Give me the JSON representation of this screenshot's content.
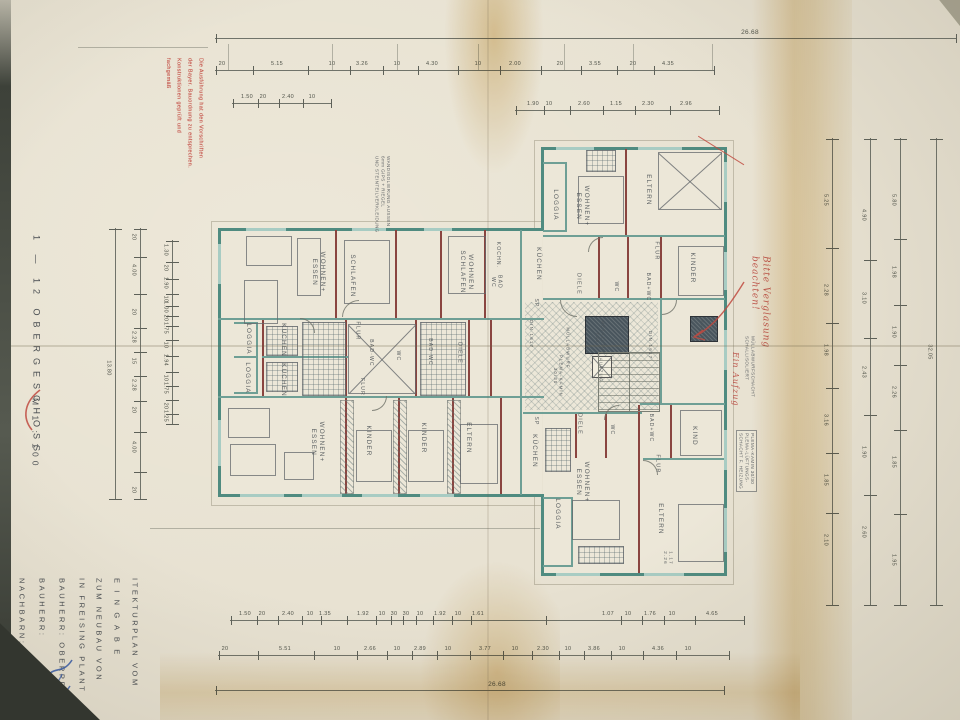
{
  "margin": {
    "floor_title": "1 — 12 OBERGESCHOSS",
    "scale": "M 1 : 100",
    "title_block_columns": [
      "ITEKTURPLAN VOM",
      "E I N G A B E",
      "ZUM NEUBAU VON",
      "IN FREISING PLANT",
      "BAUHERR: OBERPRIELER &",
      "BAUHERR:",
      "NACHBARN:"
    ]
  },
  "stamp": {
    "lines": [
      "Die Ausführung hat den Vorschriften",
      "der Bayer. Bauordnung zu entsprechen.",
      "Konstruktionen geprüft und",
      "fachgemäß"
    ]
  },
  "red_notes": {
    "note1": "Bitte Verglasung\nbeachten!",
    "note2": "Ein Aufzug"
  },
  "printed_notes": {
    "wall_note": {
      "x": 374,
      "y": 156,
      "lines": [
        "WANDISOLIERUNG AUSSEN",
        "6mm GIPS + RIEGEL",
        "UND STEINTEILVERKLEIDUNG"
      ]
    },
    "shaft_note_a": {
      "x": 744,
      "y": 336,
      "lines": [
        "MÜLLABWURFSCHACHT",
        "SCHALLISOLIERT"
      ]
    },
    "shaft_note_b": {
      "x": 736,
      "y": 430,
      "boxed": true,
      "lines": [
        "PLEMA-KAMIN 30/30",
        "PLEMA-LÜFTUNGS-",
        "SCHACHT F. HEIZUNG"
      ]
    }
  },
  "rooms": [
    {
      "t": "WOHNEN+\nESSEN",
      "x": 318,
      "y": 272
    },
    {
      "t": "SCHLAFEN",
      "x": 352,
      "y": 276
    },
    {
      "t": "WOHNEN\nSCHLAFEN",
      "x": 466,
      "y": 272
    },
    {
      "t": "KOCHN.",
      "x": 498,
      "y": 255,
      "s": 5
    },
    {
      "t": "BAD\nWC",
      "x": 496,
      "y": 282,
      "s": 5
    },
    {
      "t": "KÜCHEN",
      "x": 538,
      "y": 264
    },
    {
      "t": "SP",
      "x": 536,
      "y": 303,
      "s": 5
    },
    {
      "t": "LOGGIA",
      "x": 248,
      "y": 339
    },
    {
      "t": "LOGGIA",
      "x": 247,
      "y": 378
    },
    {
      "t": "KÜCHEN",
      "x": 283,
      "y": 340
    },
    {
      "t": "KÜCHEN",
      "x": 283,
      "y": 380
    },
    {
      "t": "FLUR",
      "x": 357,
      "y": 331,
      "s": 5.5
    },
    {
      "t": "BAD·WC",
      "x": 371,
      "y": 353,
      "s": 5
    },
    {
      "t": "WC",
      "x": 398,
      "y": 356,
      "s": 5
    },
    {
      "t": "BAD·WC",
      "x": 430,
      "y": 352,
      "s": 5
    },
    {
      "t": "DIELE",
      "x": 459,
      "y": 353,
      "s": 5.5
    },
    {
      "t": "FLUR",
      "x": 362,
      "y": 387,
      "s": 5
    },
    {
      "t": "WOHNEN+\nESSEN",
      "x": 317,
      "y": 442
    },
    {
      "t": "KINDER",
      "x": 368,
      "y": 441
    },
    {
      "t": "KINDER",
      "x": 423,
      "y": 438
    },
    {
      "t": "ELTERN",
      "x": 468,
      "y": 438
    },
    {
      "t": "LOGGIA",
      "x": 555,
      "y": 205
    },
    {
      "t": "WOHNEN+\nESSEN",
      "x": 582,
      "y": 206
    },
    {
      "t": "ELTERN",
      "x": 648,
      "y": 190
    },
    {
      "t": "KINDER",
      "x": 692,
      "y": 268
    },
    {
      "t": "FLUR",
      "x": 656,
      "y": 251,
      "s": 5.5
    },
    {
      "t": "BAD+WC",
      "x": 648,
      "y": 287,
      "s": 5
    },
    {
      "t": "WC",
      "x": 616,
      "y": 287,
      "s": 5
    },
    {
      "t": "DIELE",
      "x": 578,
      "y": 284,
      "s": 5.5
    },
    {
      "t": "DIN 1617",
      "x": 531,
      "y": 334,
      "s": 4.5
    },
    {
      "t": "DIN 1617",
      "x": 650,
      "y": 345,
      "s": 4.5
    },
    {
      "t": "MÜLLABWURF",
      "x": 568,
      "y": 348,
      "s": 4.2
    },
    {
      "t": "METALLTÜR\nT30",
      "x": 600,
      "y": 338,
      "s": 4.2
    },
    {
      "t": "PLEMA-KAMIN\n30/30",
      "x": 558,
      "y": 376,
      "s": 4.2
    },
    {
      "t": "AUFZUG",
      "x": 601,
      "y": 370,
      "s": 4.2
    },
    {
      "t": "KAMIN",
      "x": 702,
      "y": 330,
      "s": 4.2
    },
    {
      "t": "SP",
      "x": 536,
      "y": 421,
      "s": 5
    },
    {
      "t": "KÜCHEN",
      "x": 534,
      "y": 451
    },
    {
      "t": "DIELE",
      "x": 579,
      "y": 424,
      "s": 5.5
    },
    {
      "t": "WC",
      "x": 612,
      "y": 430,
      "s": 5
    },
    {
      "t": "BAD+WC",
      "x": 651,
      "y": 428,
      "s": 5
    },
    {
      "t": "KIND",
      "x": 694,
      "y": 436
    },
    {
      "t": "FLUR",
      "x": 657,
      "y": 464,
      "s": 5.5
    },
    {
      "t": "WOHNEN+\nESSEN",
      "x": 582,
      "y": 482
    },
    {
      "t": "LOGGIA",
      "x": 557,
      "y": 514
    },
    {
      "t": "ELTERN",
      "x": 660,
      "y": 519
    },
    {
      "t": "1.17\n2.26",
      "x": 668,
      "y": 558,
      "s": 4.5
    }
  ],
  "walls": [
    [
      218,
      228,
      326,
      3,
      "wt"
    ],
    [
      218,
      494,
      326,
      3,
      "wt"
    ],
    [
      218,
      228,
      3,
      269,
      "wt"
    ],
    [
      541,
      147,
      186,
      3,
      "wt"
    ],
    [
      724,
      147,
      3,
      429,
      "wt"
    ],
    [
      541,
      573,
      186,
      3,
      "wt"
    ],
    [
      541,
      147,
      3,
      84,
      "wt"
    ],
    [
      541,
      494,
      3,
      82,
      "wt"
    ],
    [
      218,
      318,
      326,
      2,
      "wi"
    ],
    [
      218,
      396,
      326,
      2,
      "wi"
    ],
    [
      543,
      235,
      182,
      2,
      "wi"
    ],
    [
      543,
      298,
      182,
      2,
      "wi"
    ],
    [
      640,
      403,
      85,
      2,
      "wi"
    ],
    [
      523,
      412,
      119,
      2,
      "wi"
    ],
    [
      643,
      458,
      82,
      2,
      "wi"
    ],
    [
      660,
      300,
      2,
      103,
      "wi"
    ],
    [
      520,
      230,
      2,
      265,
      "wi"
    ],
    [
      335,
      230,
      2,
      88,
      "wr"
    ],
    [
      395,
      230,
      2,
      88,
      "wr"
    ],
    [
      440,
      230,
      2,
      88,
      "wr"
    ],
    [
      484,
      230,
      2,
      88,
      "wr"
    ],
    [
      262,
      320,
      2,
      76,
      "wr"
    ],
    [
      345,
      320,
      2,
      76,
      "wr"
    ],
    [
      415,
      320,
      2,
      76,
      "wr"
    ],
    [
      468,
      320,
      2,
      76,
      "wr"
    ],
    [
      490,
      320,
      2,
      76,
      "wr"
    ],
    [
      262,
      356,
      86,
      2,
      "wi"
    ],
    [
      345,
      398,
      2,
      96,
      "wr"
    ],
    [
      398,
      398,
      2,
      96,
      "wr"
    ],
    [
      452,
      398,
      2,
      96,
      "wr"
    ],
    [
      500,
      398,
      2,
      96,
      "wr"
    ],
    [
      625,
      149,
      2,
      86,
      "wr"
    ],
    [
      598,
      237,
      2,
      61,
      "wr"
    ],
    [
      627,
      237,
      2,
      61,
      "wr"
    ],
    [
      660,
      237,
      2,
      61,
      "wr"
    ],
    [
      638,
      405,
      2,
      168,
      "wr"
    ],
    [
      575,
      414,
      2,
      44,
      "wr"
    ],
    [
      605,
      414,
      2,
      44,
      "wr"
    ],
    [
      670,
      405,
      2,
      53,
      "wr"
    ],
    [
      234,
      322,
      24,
      2,
      "wi"
    ],
    [
      234,
      356,
      24,
      2,
      "wi"
    ],
    [
      234,
      392,
      24,
      2,
      "wi"
    ],
    [
      256,
      322,
      2,
      72,
      "wi"
    ],
    [
      543,
      162,
      24,
      2,
      "wi"
    ],
    [
      565,
      162,
      2,
      70,
      "wi"
    ],
    [
      543,
      230,
      24,
      2,
      "wi"
    ],
    [
      543,
      497,
      30,
      2,
      "wi"
    ],
    [
      571,
      497,
      2,
      70,
      "wi"
    ],
    [
      543,
      565,
      30,
      2,
      "wi"
    ]
  ],
  "fills": [
    [
      220,
      230,
      322,
      264
    ],
    [
      543,
      149,
      182,
      424
    ]
  ],
  "outlines": [
    [
      211,
      221,
      340,
      283
    ],
    [
      534,
      140,
      198,
      443
    ]
  ],
  "hatch_area": [
    525,
    302,
    133,
    108
  ],
  "windows": [
    [
      246,
      228,
      40,
      3
    ],
    [
      352,
      228,
      34,
      3
    ],
    [
      424,
      228,
      28,
      3
    ],
    [
      240,
      494,
      44,
      3
    ],
    [
      302,
      494,
      40,
      3
    ],
    [
      362,
      494,
      36,
      3
    ],
    [
      420,
      494,
      34,
      3
    ],
    [
      556,
      147,
      38,
      3
    ],
    [
      638,
      147,
      44,
      3
    ],
    [
      556,
      573,
      44,
      3
    ],
    [
      644,
      573,
      40,
      3
    ],
    [
      218,
      244,
      3,
      40
    ],
    [
      218,
      420,
      3,
      46
    ],
    [
      724,
      162,
      3,
      40
    ],
    [
      724,
      252,
      3,
      38
    ],
    [
      724,
      330,
      3,
      40
    ],
    [
      724,
      430,
      3,
      40
    ],
    [
      724,
      508,
      3,
      44
    ]
  ],
  "furniture": [
    [
      "rect",
      246,
      236,
      44,
      28
    ],
    [
      "rect",
      244,
      280,
      32,
      42
    ],
    [
      "rect",
      297,
      238,
      22,
      56
    ],
    [
      "rect",
      344,
      240,
      44,
      62
    ],
    [
      "rect",
      448,
      236,
      36,
      56
    ],
    [
      "grid",
      266,
      326,
      30,
      28
    ],
    [
      "grid",
      266,
      362,
      30,
      28
    ],
    [
      "grid",
      302,
      322,
      42,
      72
    ],
    [
      "grid",
      420,
      322,
      44,
      72
    ],
    [
      "xbox",
      348,
      324,
      66,
      68
    ],
    [
      "xbox",
      658,
      152,
      62,
      56
    ],
    [
      "rect",
      578,
      176,
      44,
      46
    ],
    [
      "grid",
      586,
      150,
      28,
      20
    ],
    [
      "rect",
      678,
      246,
      44,
      48
    ],
    [
      "hatch",
      340,
      400,
      12,
      92
    ],
    [
      "hatch",
      393,
      400,
      12,
      92
    ],
    [
      "hatch",
      447,
      400,
      12,
      92
    ],
    [
      "rect",
      356,
      430,
      34,
      50
    ],
    [
      "rect",
      408,
      430,
      34,
      50
    ],
    [
      "rect",
      460,
      424,
      36,
      58
    ],
    [
      "rect",
      228,
      408,
      40,
      28
    ],
    [
      "rect",
      230,
      444,
      44,
      30
    ],
    [
      "rect",
      284,
      452,
      28,
      26
    ],
    [
      "grid",
      545,
      428,
      24,
      42
    ],
    [
      "rect",
      572,
      500,
      46,
      38
    ],
    [
      "grid",
      578,
      546,
      44,
      16
    ],
    [
      "rect",
      678,
      504,
      44,
      56
    ],
    [
      "rect",
      680,
      410,
      40,
      44
    ],
    [
      "dark",
      585,
      316,
      42,
      36
    ],
    [
      "dark",
      690,
      316,
      26,
      24
    ],
    [
      "car",
      592,
      356,
      18,
      20
    ],
    [
      "stair",
      598,
      352,
      60,
      58
    ]
  ],
  "doors": [
    [
      342,
      300,
      16,
      0
    ],
    [
      300,
      318,
      14,
      90
    ],
    [
      372,
      396,
      14,
      180
    ],
    [
      560,
      300,
      16,
      270
    ],
    [
      604,
      405,
      14,
      0
    ],
    [
      643,
      460,
      14,
      90
    ],
    [
      588,
      237,
      14,
      0
    ],
    [
      662,
      300,
      14,
      180
    ]
  ],
  "dims_h": [
    {
      "x": 215,
      "y": 38,
      "w": 742,
      "big": true,
      "labels": [
        [
          750,
          "26.68"
        ]
      ]
    },
    {
      "x": 215,
      "y": 70,
      "w": 500,
      "labels": [
        [
          222,
          "20"
        ],
        [
          277,
          "5.15"
        ],
        [
          332,
          "10"
        ],
        [
          362,
          "3.26"
        ],
        [
          397,
          "10"
        ],
        [
          432,
          "4.30"
        ],
        [
          478,
          "10"
        ],
        [
          515,
          "2.00"
        ],
        [
          560,
          "20"
        ],
        [
          595,
          "3.55"
        ],
        [
          633,
          "20"
        ],
        [
          668,
          "4.35"
        ]
      ]
    },
    {
      "x": 232,
      "y": 103,
      "w": 100,
      "labels": [
        [
          247,
          "1.50"
        ],
        [
          263,
          "20"
        ],
        [
          288,
          "2.40"
        ],
        [
          312,
          "10"
        ]
      ]
    },
    {
      "x": 515,
      "y": 110,
      "w": 205,
      "labels": [
        [
          533,
          "1.90"
        ],
        [
          549,
          "10"
        ],
        [
          584,
          "2.60"
        ],
        [
          616,
          "1.15"
        ],
        [
          648,
          "2.30"
        ],
        [
          686,
          "2.96"
        ]
      ]
    },
    {
      "x": 230,
      "y": 620,
      "w": 515,
      "labels": [
        [
          245,
          "1.50"
        ],
        [
          262,
          "20"
        ],
        [
          288,
          "2.40"
        ],
        [
          310,
          "10"
        ],
        [
          325,
          "1.35"
        ],
        [
          363,
          "1.92"
        ],
        [
          382,
          "10"
        ],
        [
          394,
          "30"
        ],
        [
          406,
          "30"
        ],
        [
          420,
          "10"
        ],
        [
          440,
          "1.92"
        ],
        [
          458,
          "10"
        ],
        [
          478,
          "1.61"
        ],
        [
          608,
          "1.07"
        ],
        [
          628,
          "10"
        ],
        [
          650,
          "1.76"
        ],
        [
          672,
          "10"
        ],
        [
          712,
          "4.65"
        ]
      ]
    },
    {
      "x": 218,
      "y": 655,
      "w": 512,
      "labels": [
        [
          225,
          "20"
        ],
        [
          285,
          "5.51"
        ],
        [
          337,
          "10"
        ],
        [
          370,
          "2.66"
        ],
        [
          397,
          "10"
        ],
        [
          420,
          "2.89"
        ],
        [
          448,
          "10"
        ],
        [
          485,
          "3.77"
        ],
        [
          515,
          "10"
        ],
        [
          543,
          "2.30"
        ],
        [
          568,
          "10"
        ],
        [
          594,
          "3.86"
        ],
        [
          622,
          "10"
        ],
        [
          658,
          "4.36"
        ],
        [
          688,
          "10"
        ]
      ]
    },
    {
      "x": 215,
      "y": 690,
      "w": 510,
      "big": true,
      "labels": [
        [
          497,
          "26.68"
        ]
      ]
    }
  ],
  "dims_v": [
    {
      "x": 115,
      "y": 228,
      "h": 272,
      "labels": [
        [
          368,
          "13.80"
        ]
      ]
    },
    {
      "x": 140,
      "y": 228,
      "h": 272,
      "labels": [
        [
          237,
          "20"
        ],
        [
          270,
          "4.00"
        ],
        [
          312,
          "20"
        ],
        [
          337,
          "2.28"
        ],
        [
          361,
          "15"
        ],
        [
          385,
          "2.28"
        ],
        [
          410,
          "20"
        ],
        [
          447,
          "4.00"
        ],
        [
          490,
          "20"
        ]
      ]
    },
    {
      "x": 172,
      "y": 240,
      "h": 185,
      "labels": [
        [
          250,
          "1.30"
        ],
        [
          268,
          "20"
        ],
        [
          283,
          "1.90"
        ],
        [
          299,
          "10"
        ],
        [
          307,
          "1.00"
        ],
        [
          318,
          "20"
        ],
        [
          328,
          "1.75"
        ],
        [
          345,
          "10"
        ],
        [
          360,
          "1.94"
        ],
        [
          378,
          "10"
        ],
        [
          388,
          "1.75"
        ],
        [
          406,
          "20"
        ],
        [
          416,
          "1.25"
        ]
      ]
    },
    {
      "x": 832,
      "y": 138,
      "h": 468,
      "labels": [
        [
          200,
          "5.25"
        ],
        [
          290,
          "2.28"
        ],
        [
          350,
          "1.98"
        ],
        [
          420,
          "3.16"
        ],
        [
          480,
          "1.85"
        ],
        [
          540,
          "2.10"
        ]
      ]
    },
    {
      "x": 870,
      "y": 138,
      "h": 468,
      "labels": [
        [
          215,
          "4.90"
        ],
        [
          298,
          "3.10"
        ],
        [
          372,
          "2.43"
        ],
        [
          452,
          "1.90"
        ],
        [
          532,
          "2.60"
        ]
      ]
    },
    {
      "x": 900,
      "y": 138,
      "h": 468,
      "labels": [
        [
          200,
          "5.80"
        ],
        [
          272,
          "1.98"
        ],
        [
          332,
          "1.90"
        ],
        [
          392,
          "2.26"
        ],
        [
          462,
          "1.85"
        ],
        [
          560,
          "1.95"
        ]
      ]
    },
    {
      "x": 936,
      "y": 138,
      "h": 468,
      "labels": [
        [
          352,
          "32.05"
        ]
      ]
    }
  ],
  "flines": [
    [
      78,
      47,
      130,
      "h"
    ],
    [
      150,
      528,
      390,
      "h"
    ],
    [
      228,
      44,
      26,
      "v"
    ],
    [
      332,
      44,
      26,
      "v"
    ],
    [
      397,
      44,
      26,
      "v"
    ],
    [
      478,
      44,
      26,
      "v"
    ],
    [
      564,
      44,
      26,
      "v"
    ],
    [
      633,
      44,
      26,
      "v"
    ],
    [
      712,
      44,
      26,
      "v"
    ]
  ],
  "title_block": {
    "y": 578,
    "cols_x": [
      130,
      112,
      94,
      77,
      57,
      37,
      17
    ]
  },
  "colors": {
    "paper": "#e7e1d1",
    "wall_teal": "#4f8b80",
    "wall_red": "#8a4540",
    "stamp_red": "#c0453c",
    "ink_blue": "#3b5ea9"
  }
}
